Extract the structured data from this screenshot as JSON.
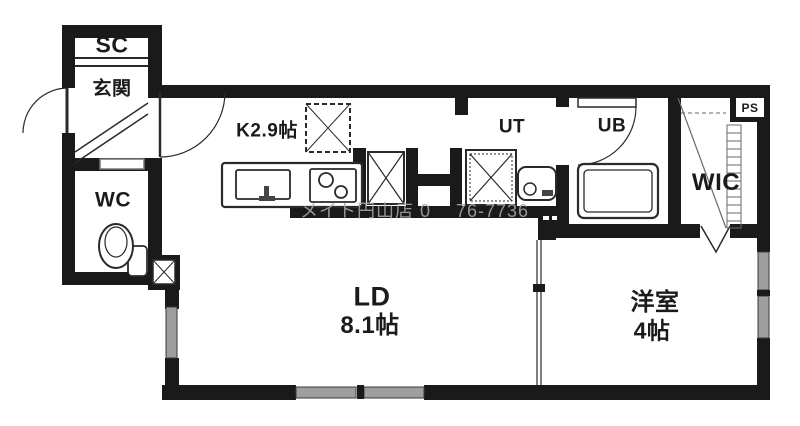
{
  "rooms": {
    "sc": {
      "label": "SC"
    },
    "genkan": {
      "label": "玄関"
    },
    "wc": {
      "label": "WC"
    },
    "kitchen": {
      "label": "K2.9帖"
    },
    "ut": {
      "label": "UT"
    },
    "ub": {
      "label": "UB"
    },
    "wic": {
      "label": "WIC"
    },
    "ps": {
      "label": "PS"
    },
    "ld": {
      "label": "LD",
      "size": "8.1帖"
    },
    "western": {
      "label": "洋室",
      "size": "4帖"
    }
  },
  "watermark": {
    "text": "メイト円山店 0　 76-7736"
  },
  "fixtures": [
    "refrigerator-icon",
    "kitchen-sink-icon",
    "gas-stove-icon",
    "washing-machine-pan-icon",
    "washbasin-icon",
    "bathtub-icon",
    "toilet-icon"
  ],
  "colors": {
    "wall": "#1a1a1a",
    "line": "#2a2a2a",
    "window": "#9e9e9e",
    "label": "#1b1b1b",
    "watermark": "#ababab",
    "background": "#ffffff"
  }
}
